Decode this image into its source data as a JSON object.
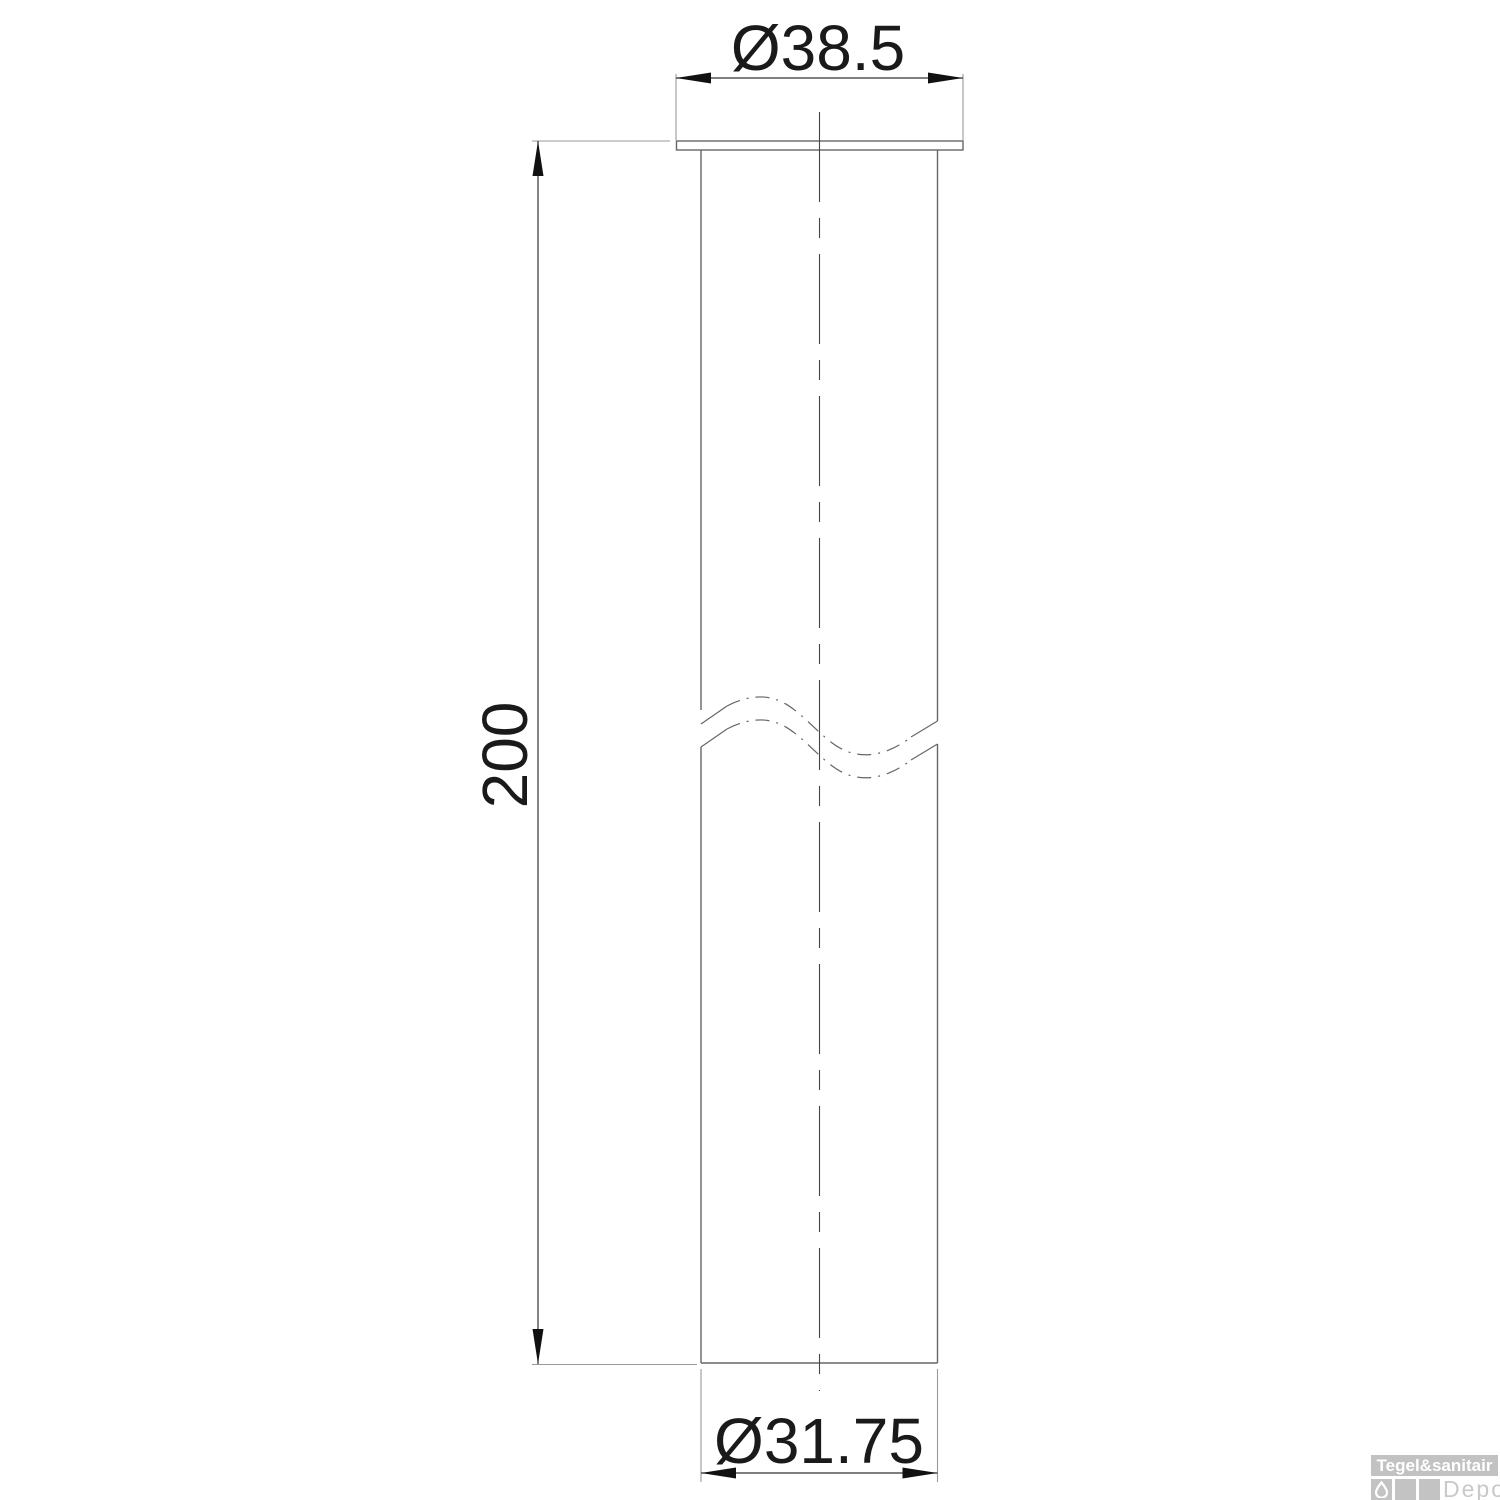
{
  "drawing": {
    "title": "flanged-tube-dimension-drawing",
    "dimensions": {
      "top_diameter": "Ø38.5",
      "length": "200",
      "bottom_diameter": "Ø31.75"
    }
  },
  "watermark": {
    "brand": "Tegel&sanitair",
    "sub_brand": "Depot",
    "icon": "water-drop-icon"
  },
  "colors": {
    "background": "#ffffff",
    "outline": "#666666",
    "extension_line": "#999999",
    "dimension_line": "#333333",
    "arrow_and_text": "#111111",
    "centerline": "#444444",
    "logo_gray": "#c2c2c2",
    "logo_text": "#ffffff",
    "logo_depot_text": "#c9c9c9"
  }
}
